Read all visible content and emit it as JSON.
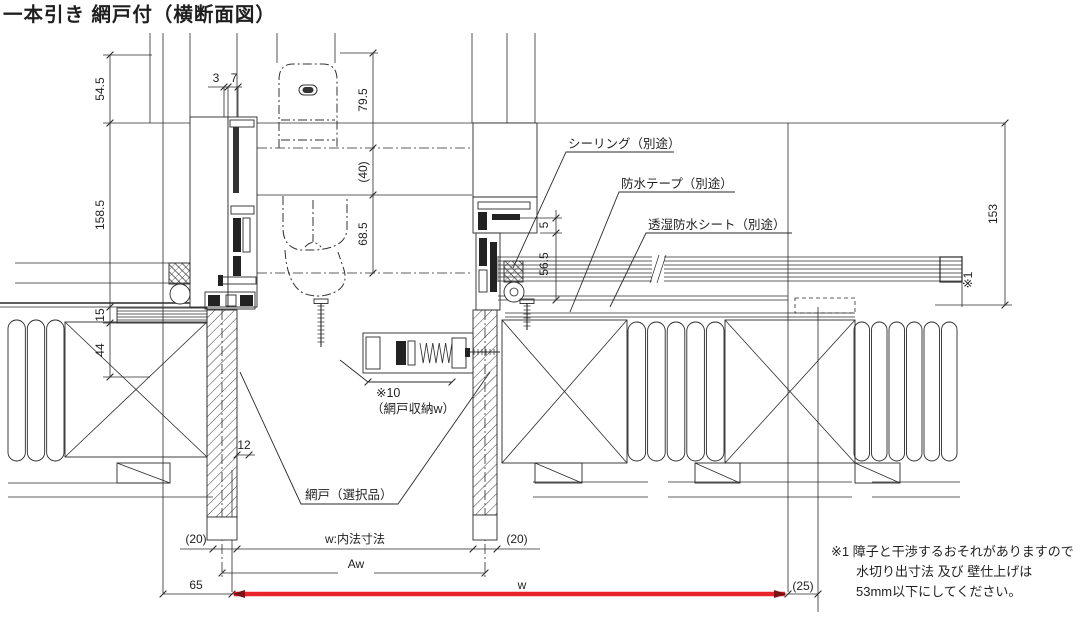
{
  "title": "一本引き 網戸付（横断面図）",
  "callouts": {
    "sealing": "シーリング（別途）",
    "tape": "防水テープ（別途）",
    "sheet": "透湿防水シート（別途）",
    "screen": "網戸（選択品）",
    "housing_ref": "※10",
    "housing_label": "（網戸収納w）"
  },
  "dimensions": {
    "head_offset": "54.5",
    "jamb_depth": "158.5",
    "small_a": "3",
    "small_b": "7",
    "handle_out": "79.5",
    "handle_gap": "(40)",
    "handle_in": "68.5",
    "seal_gap": "5",
    "frame_to_siding": "56.5",
    "wall_total": "153",
    "wall_ref": "※1",
    "flashing": "15",
    "sill_depth": "44",
    "pillar_gap": "12",
    "clear_left": "(20)",
    "clear_width": "w:内法寸法",
    "clear_right": "(20)",
    "aw": "Aw",
    "left_offset": "65",
    "rough_width": "w",
    "right_offset": "(25)"
  },
  "note": {
    "line1": "※1 障子と干渉するおそれがありますので",
    "line2": "水切り出寸法 及び 壁仕上げは",
    "line3": "53mm以下にしてください。"
  },
  "colors": {
    "line": "#2a2a2a",
    "highlight": "#e8232a",
    "arrow": "#7c1216"
  }
}
